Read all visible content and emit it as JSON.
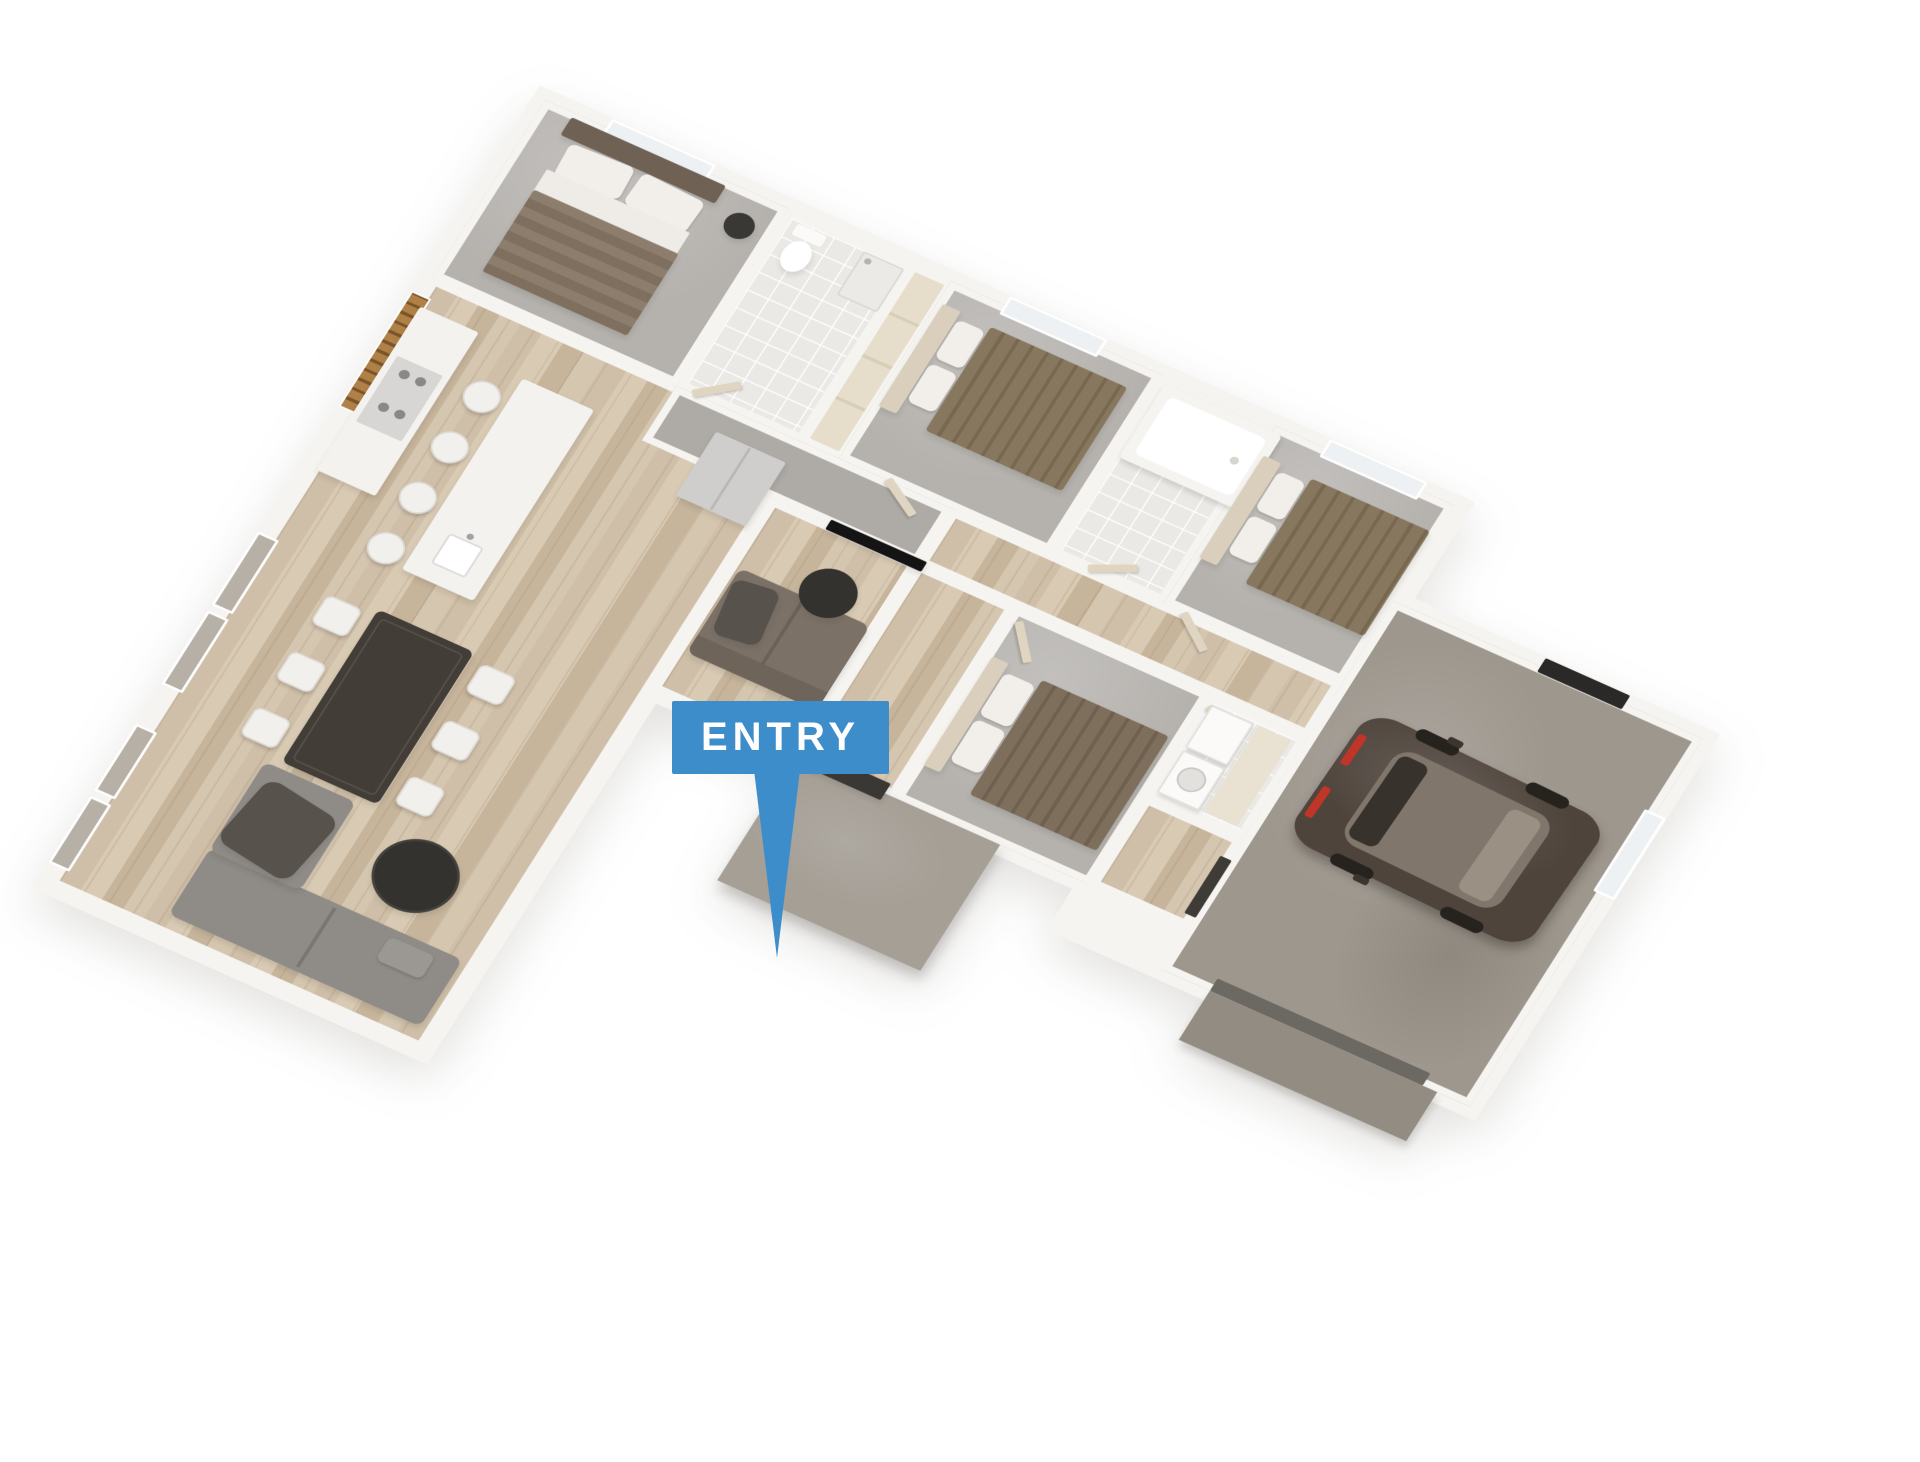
{
  "entry_callout": {
    "label": "ENTRY"
  },
  "colors": {
    "blue": "#3d8dcb",
    "wall": "#f6f4f1",
    "carpet": "#b5b2ae",
    "hall_carpet": "#aeaba6",
    "tile": "#ebe9e5",
    "concrete": "#9e978e",
    "porch": "#a59f96",
    "wood_base": "#d2c2ab",
    "sofa_gray": "#8f8b87",
    "sofa_brown": "#7c7166",
    "throw_dark": "#57524b",
    "table_dark": "#433d37",
    "chair_white": "#f2f0ed",
    "island_white": "#f4f2ef",
    "steel": "#cfcecc",
    "slat_wood": "#b08147",
    "slat_gap": "#7b5529",
    "blanket_brown": "#87775f",
    "blanket_brown_dark": "#7e6e5c",
    "headboard_brown": "#6f6153",
    "headboard_cream": "#d9cfbc",
    "pillow_white": "#f2efeb",
    "car_body": "#4e443c",
    "car_glass": "#80766b",
    "car_light": "#bf3527",
    "door_cream": "#dfd5c0",
    "door_dark": "#3a3835",
    "garage_door": "#6c6862",
    "window_glass": "#eef1f3",
    "window_gray": "#b7b0a7",
    "tv_black": "#141414",
    "coffee_table": "#34322e"
  },
  "objects": [
    "master-bed",
    "side-table",
    "toilet",
    "shower",
    "bathtub",
    "bed-2",
    "bed-3",
    "bed-4",
    "wardrobe",
    "kitchen-counter",
    "cooktop",
    "fridge",
    "kitchen-island",
    "sink",
    "bar-stools",
    "slat-screen",
    "dining-table",
    "dining-chairs",
    "sectional-sofa",
    "coffee-table",
    "family-sofa",
    "tv",
    "washer",
    "dryer",
    "car",
    "garage-door",
    "front-door",
    "entry-porch"
  ]
}
